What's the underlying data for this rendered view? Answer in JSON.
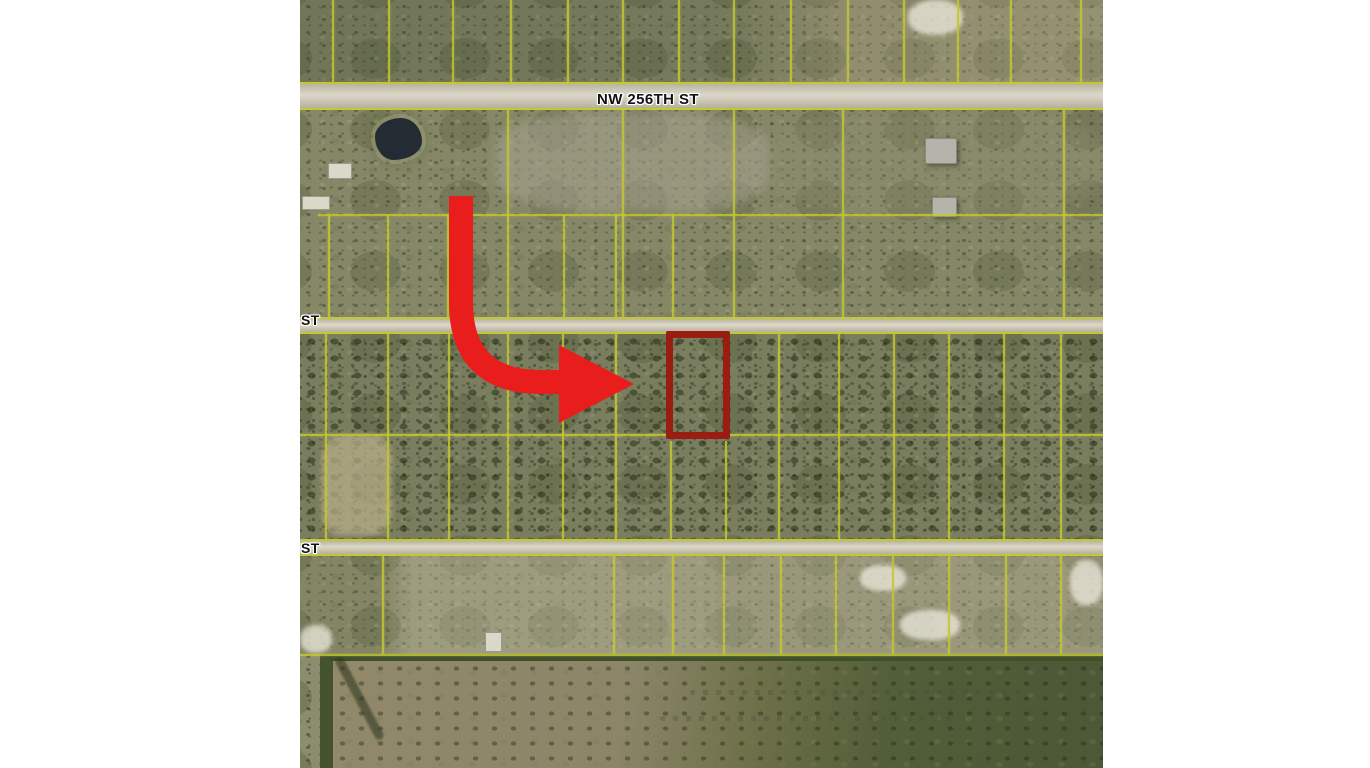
{
  "map": {
    "streets": {
      "main": "NW 256TH ST",
      "cross_upper": "ST",
      "cross_lower": "ST"
    },
    "colors": {
      "map_base": "#8c8d6e",
      "parcel_line": "#c3c832",
      "road_surface": "#cdc8b6",
      "arrow_red": "#ea1d1d",
      "highlight_outline": "#9a1d12",
      "pond": "#232c33"
    },
    "highlight": {
      "parcel": {
        "x": 366,
        "y": 331,
        "width": 64,
        "height": 108,
        "border": 7
      },
      "arrow_tip": {
        "x": 334,
        "y": 384
      }
    },
    "grid": {
      "vertical_lines": [
        {
          "x": 32,
          "y1": 0,
          "y2": 82
        },
        {
          "x": 88,
          "y1": 0,
          "y2": 82
        },
        {
          "x": 152,
          "y1": 0,
          "y2": 82
        },
        {
          "x": 210,
          "y1": 0,
          "y2": 82
        },
        {
          "x": 267,
          "y1": 0,
          "y2": 82
        },
        {
          "x": 322,
          "y1": 0,
          "y2": 82
        },
        {
          "x": 378,
          "y1": 0,
          "y2": 82
        },
        {
          "x": 433,
          "y1": 0,
          "y2": 82
        },
        {
          "x": 490,
          "y1": 0,
          "y2": 82
        },
        {
          "x": 547,
          "y1": 0,
          "y2": 82
        },
        {
          "x": 603,
          "y1": 0,
          "y2": 82
        },
        {
          "x": 657,
          "y1": 0,
          "y2": 82
        },
        {
          "x": 710,
          "y1": 0,
          "y2": 82
        },
        {
          "x": 780,
          "y1": 0,
          "y2": 82
        },
        {
          "x": 207,
          "y1": 110,
          "y2": 317
        },
        {
          "x": 322,
          "y1": 110,
          "y2": 317
        },
        {
          "x": 433,
          "y1": 110,
          "y2": 317
        },
        {
          "x": 542,
          "y1": 110,
          "y2": 317
        },
        {
          "x": 763,
          "y1": 110,
          "y2": 317
        },
        {
          "x": 28,
          "y1": 214,
          "y2": 317
        },
        {
          "x": 87,
          "y1": 214,
          "y2": 317
        },
        {
          "x": 147,
          "y1": 214,
          "y2": 317
        },
        {
          "x": 263,
          "y1": 214,
          "y2": 317
        },
        {
          "x": 315,
          "y1": 214,
          "y2": 317
        },
        {
          "x": 372,
          "y1": 214,
          "y2": 317
        },
        {
          "x": 25,
          "y1": 333,
          "y2": 539
        },
        {
          "x": 87,
          "y1": 333,
          "y2": 539
        },
        {
          "x": 148,
          "y1": 333,
          "y2": 539
        },
        {
          "x": 207,
          "y1": 333,
          "y2": 539
        },
        {
          "x": 262,
          "y1": 333,
          "y2": 539
        },
        {
          "x": 315,
          "y1": 333,
          "y2": 539
        },
        {
          "x": 478,
          "y1": 333,
          "y2": 539
        },
        {
          "x": 538,
          "y1": 333,
          "y2": 539
        },
        {
          "x": 593,
          "y1": 333,
          "y2": 539
        },
        {
          "x": 648,
          "y1": 333,
          "y2": 539
        },
        {
          "x": 703,
          "y1": 333,
          "y2": 539
        },
        {
          "x": 760,
          "y1": 333,
          "y2": 539
        },
        {
          "x": 370,
          "y1": 441,
          "y2": 539
        },
        {
          "x": 425,
          "y1": 441,
          "y2": 539
        },
        {
          "x": 82,
          "y1": 556,
          "y2": 654
        },
        {
          "x": 313,
          "y1": 556,
          "y2": 654
        },
        {
          "x": 372,
          "y1": 556,
          "y2": 654
        },
        {
          "x": 423,
          "y1": 556,
          "y2": 654
        },
        {
          "x": 480,
          "y1": 556,
          "y2": 654
        },
        {
          "x": 535,
          "y1": 556,
          "y2": 654
        },
        {
          "x": 592,
          "y1": 556,
          "y2": 654
        },
        {
          "x": 648,
          "y1": 556,
          "y2": 654
        },
        {
          "x": 705,
          "y1": 556,
          "y2": 654
        },
        {
          "x": 760,
          "y1": 556,
          "y2": 654
        }
      ],
      "horizontal_lines": [
        {
          "y": 214,
          "x1": 18,
          "x2": 803
        },
        {
          "y": 434,
          "x1": 0,
          "x2": 803
        },
        {
          "y": 654,
          "x1": 0,
          "x2": 803
        }
      ]
    },
    "features": [
      {
        "kind": "pond",
        "x": 75,
        "y": 118,
        "w": 47,
        "h": 42
      },
      {
        "kind": "house",
        "x": 625,
        "y": 138,
        "w": 30,
        "h": 24
      },
      {
        "kind": "house",
        "x": 632,
        "y": 197,
        "w": 23,
        "h": 18
      },
      {
        "kind": "shed",
        "x": 28,
        "y": 163,
        "w": 22,
        "h": 14
      },
      {
        "kind": "shed",
        "x": 2,
        "y": 196,
        "w": 26,
        "h": 12
      },
      {
        "kind": "shed",
        "x": 185,
        "y": 632,
        "w": 15,
        "h": 18
      },
      {
        "kind": "sand-patch",
        "x": 608,
        "y": 0,
        "w": 55,
        "h": 35
      },
      {
        "kind": "sand-patch",
        "x": 0,
        "y": 625,
        "w": 32,
        "h": 28
      },
      {
        "kind": "sand-patch",
        "x": 560,
        "y": 565,
        "w": 46,
        "h": 26
      },
      {
        "kind": "sand-patch",
        "x": 600,
        "y": 610,
        "w": 60,
        "h": 30
      },
      {
        "kind": "sand-patch",
        "x": 770,
        "y": 560,
        "w": 33,
        "h": 45
      },
      {
        "kind": "clearing",
        "x": 22,
        "y": 435,
        "w": 70,
        "h": 100
      }
    ]
  }
}
